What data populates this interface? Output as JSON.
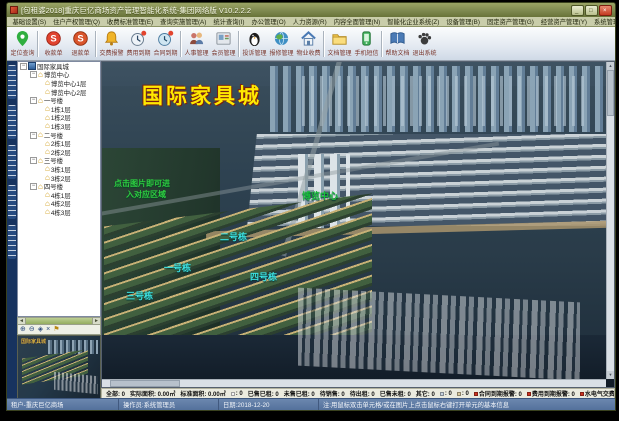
{
  "window": {
    "title": "[包租婆2018]重庆巨亿商场资产管理智能化系统-集团网络版 V10.2.2.2"
  },
  "menu": {
    "items": [
      "基础设置(S)",
      "住户产权管理(Q)",
      "收费标准管理(E)",
      "查询实施管理(A)",
      "统计查询(I)",
      "办公管理(O)",
      "人力资源(R)",
      "内容全面管理(N)",
      "智能化企业系统(Z)",
      "设备管理(B)",
      "固定资产管理(G)",
      "经营资产管理(Y)",
      "系统管理(X)",
      "帮助(H)"
    ]
  },
  "toolbar": {
    "buttons": [
      {
        "label": "定位查询",
        "icon": "map-pin"
      },
      {
        "label": "收款单",
        "icon": "coin-in"
      },
      {
        "label": "退款单",
        "icon": "coin-out"
      },
      {
        "label": "交费报警",
        "icon": "bell"
      },
      {
        "label": "费用到期",
        "icon": "clock-alert"
      },
      {
        "label": "合同到期",
        "icon": "contract-alert"
      },
      {
        "label": "人事管理",
        "icon": "people"
      },
      {
        "label": "会员管理",
        "icon": "member-card"
      },
      {
        "label": "投诉管理",
        "icon": "penguin"
      },
      {
        "label": "报修管理",
        "icon": "globe-repair"
      },
      {
        "label": "物业收费",
        "icon": "house"
      },
      {
        "label": "文档管理",
        "icon": "folder"
      },
      {
        "label": "手机短信",
        "icon": "phone-sms"
      },
      {
        "label": "帮助文档",
        "icon": "book"
      },
      {
        "label": "退出系统",
        "icon": "paw-exit"
      }
    ]
  },
  "sidebar": {
    "tree": [
      {
        "label": "国际家具城"
      },
      {
        "label": "博览中心"
      },
      {
        "label": "博览中心1层"
      },
      {
        "label": "博览中心2层"
      },
      {
        "label": "一号楼"
      },
      {
        "label": "1栋1层"
      },
      {
        "label": "1栋2层"
      },
      {
        "label": "1栋3层"
      },
      {
        "label": "二号楼"
      },
      {
        "label": "2栋1层"
      },
      {
        "label": "2栋2层"
      },
      {
        "label": "三号楼"
      },
      {
        "label": "3栋1层"
      },
      {
        "label": "3栋2层"
      },
      {
        "label": "四号楼"
      },
      {
        "label": "4栋1层"
      },
      {
        "label": "4栋2层"
      },
      {
        "label": "4栋3层"
      }
    ],
    "minimap_label": "国际家具城"
  },
  "map": {
    "title": "国际家具城",
    "hint_line1": "点击图片即可进",
    "hint_line2": "入对应区域",
    "labels": [
      {
        "text": "博览中心",
        "x": 200,
        "y": 127,
        "color": "#19c03a"
      },
      {
        "text": "二号栋",
        "x": 118,
        "y": 168,
        "color": "#3ce1e1"
      },
      {
        "text": "一号栋",
        "x": 62,
        "y": 199,
        "color": "#3ce1e1"
      },
      {
        "text": "四号栋",
        "x": 148,
        "y": 208,
        "color": "#3ce1e1"
      },
      {
        "text": "三号栋",
        "x": 24,
        "y": 227,
        "color": "#3ce1e1"
      }
    ]
  },
  "status": {
    "segments": [
      {
        "text": "全部: 0"
      },
      {
        "text": "实际面积: 0.00㎡"
      },
      {
        "text": "标准面积: 0.00㎡"
      },
      {
        "text": ": 0",
        "bullet": "#f4f4f4"
      },
      {
        "text": "已售已租: 0"
      },
      {
        "text": "未售已租: 0"
      },
      {
        "text": "待销售: 0"
      },
      {
        "text": "待出租: 0"
      },
      {
        "text": "已售未租: 0"
      },
      {
        "text": "其它: 0"
      },
      {
        "text": ": 0",
        "bullet": "#c8d4e0"
      },
      {
        "text": ": 0",
        "bullet": "#d8c8a0"
      },
      {
        "text": "合同到期报警: 0",
        "bullet": "#cc3322"
      },
      {
        "text": "费用到期报警: 0",
        "bullet": "#cc3322"
      },
      {
        "text": "水电气交费报警: 0",
        "bullet": "#cc3322"
      }
    ]
  },
  "footer": {
    "cells": [
      "租户-重庆巨亿商场",
      "操作员:系统管理员",
      "日期:2018-12-20",
      "注:用鼠标双击单元格/或在图片上点击鼠标右键打开单元的基本信息"
    ]
  },
  "colors": {
    "titlebar_olive": "#7e8950",
    "map_title_yellow": "#ffe900",
    "hint_green": "#2ecc40",
    "building_label_cyan": "#3ce1e1",
    "expo_label_green": "#19c03a"
  }
}
